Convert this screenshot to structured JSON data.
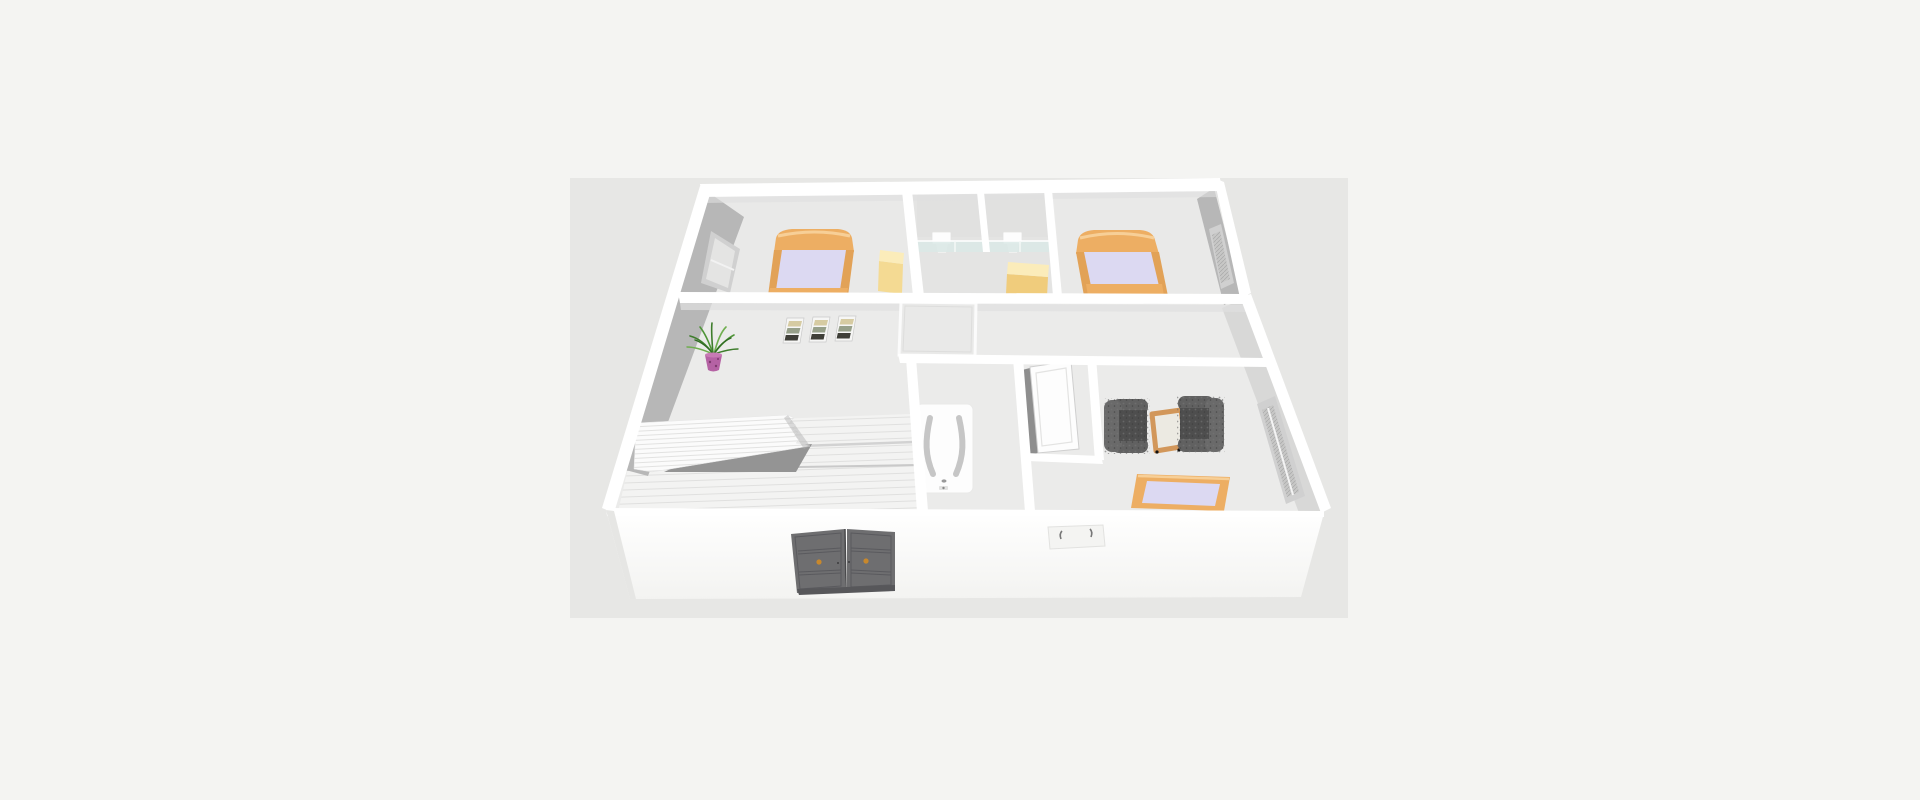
{
  "app": {
    "description": "3D rendered floor plan of a one-storey home viewed from above the south-east",
    "canvas_label": "3d-view"
  },
  "palette": {
    "pageBg": "#f4f4f2",
    "canvasBg": "#e7e7e5",
    "floorBase": "#ebebea",
    "floorRoom": "#e9e9e8",
    "floorCompartments": "#e4e4e3",
    "wallWhite": "#ffffff",
    "wallShade": "#dedede",
    "faceGray": "#b7b7b7",
    "faceGrayLight": "#d8d8d7",
    "windowRecess": "#d0d0d0",
    "windowPane": "#e4e4e3",
    "meshBase": "#c7c7c6",
    "bedFrame": "#edae63",
    "bedFrameDark": "#e2a257",
    "bedFrameLight": "#f7cf97",
    "bedding": "#dcd9f2",
    "dresserTop": "#fbecba",
    "dresserFront": "#f4da93",
    "dresserFront2": "#f0cc7c",
    "glass": "#d9e8e6",
    "fixtureWhite": "#fdfdfd",
    "fixtureShade": "#f0f0ef",
    "plantGreen": "#3e7d2c",
    "plantGreenLight": "#6fae4f",
    "potPink": "#b562a4",
    "potDark": "#7d3b6e",
    "frameWhite": "#f6f6f5",
    "frameCream": "#d6cba2",
    "frameSage": "#97a08a",
    "frameDark": "#3f3f38",
    "stairWhite": "#fbfbfb",
    "stairShadow": "#949494",
    "stairSide": "#b0b0b0",
    "tubLine": "#c6c6c6",
    "chairDark": "#4e4e4e",
    "chairMid": "#616161",
    "chairBack": "#6a6a6a",
    "tableWood": "#d2975a",
    "tableTop": "#eceae2",
    "doorGray": "#6e6e70",
    "doorGroove": "#5a5a5e",
    "doorBase": "#57575a",
    "doorKnob": "#c8882c",
    "southWall": "#fbfbfa",
    "sinkPanel": "#f4f4f2",
    "metalDark": "#777777"
  },
  "scene": {
    "rooms": [
      "bedroom-top-left",
      "toilet-compartment-left",
      "toilet-compartment-right",
      "bedroom-top-right",
      "hallway-landing",
      "stair-room",
      "bathroom",
      "wc",
      "sitting-bedroom"
    ],
    "objects": [
      "double-bed-top-left",
      "double-bed-top-right",
      "bed-bottom-right",
      "toilet-left",
      "toilet-right",
      "glass-partition",
      "dresser-left",
      "dresser-right",
      "picture-frame x3",
      "potted-plant",
      "staircase",
      "shower-tray",
      "bathtub",
      "open-white-door",
      "armchair x2",
      "folding-side-table",
      "dark-double-doors",
      "wall-basin",
      "window x3"
    ]
  }
}
